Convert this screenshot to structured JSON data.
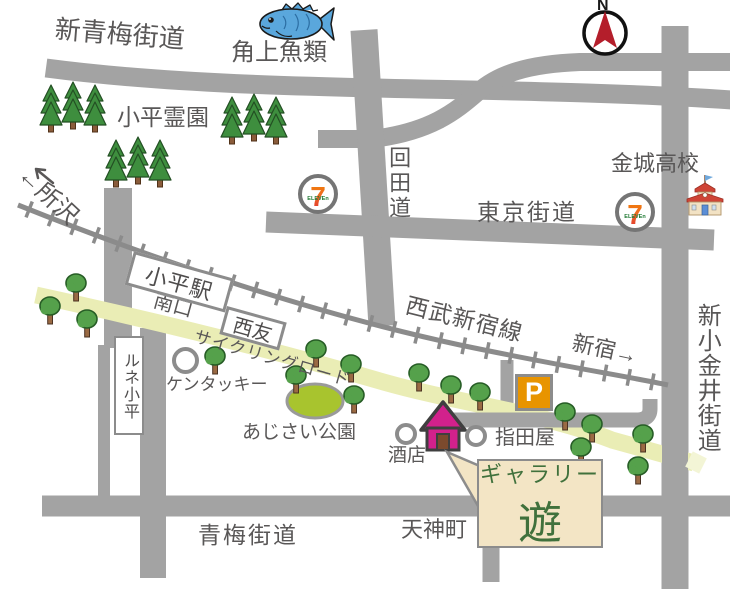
{
  "map_labels": {
    "roads": {
      "shin_oume": "新青梅街道",
      "mawarida": "回田道",
      "tokyo": "東京街道",
      "oume": "青梅街道",
      "shin_koganei": "新小金井街道",
      "cycling": "サイクリングロード"
    },
    "rail": {
      "line": "西武新宿線",
      "to_tokorozawa": "←所沢",
      "to_shinjuku": "新宿→",
      "station": "小平駅",
      "south_exit": "南口"
    },
    "places": {
      "fish_market": "角上魚類",
      "cemetery": "小平霊園",
      "high_school": "金城高校",
      "seiyu": "西友",
      "lune": "ルネ小平",
      "kfc": "ケンタッキー",
      "park": "あじさい公園",
      "sake": "酒店",
      "sashidaya": "指田屋",
      "tenjincho": "天神町"
    },
    "markers": {
      "parking": "P",
      "compass": "N",
      "seven": "7",
      "seven_sub": "ELEVEn"
    },
    "gallery": {
      "line1": "ギャラリー",
      "line2": "遊"
    }
  },
  "colors": {
    "road": "#a3a3a3",
    "rail": "#8b8b8b",
    "cycling_band": "#eaedb5",
    "gallery_pink": "#d2218c",
    "parking_orange": "#e89400",
    "callout_bg": "#f3e5c5",
    "gallery_green": "#40713c",
    "text_gray": "#595757"
  }
}
